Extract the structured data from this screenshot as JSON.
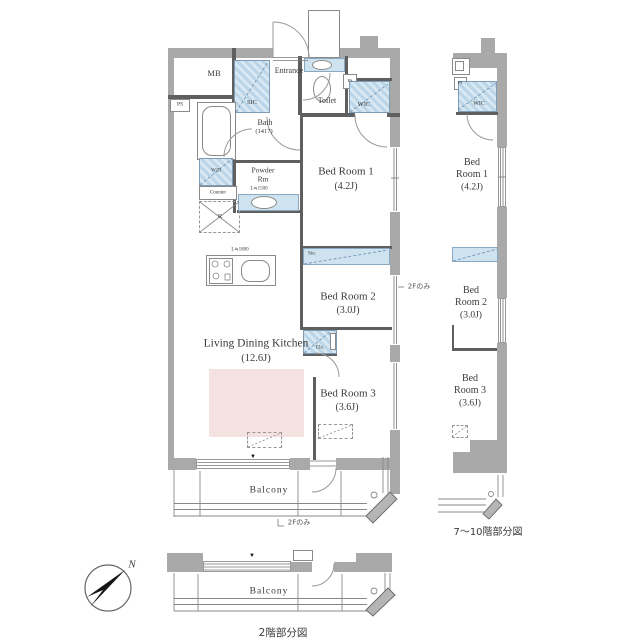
{
  "main_plan": {
    "mb": "MB",
    "ps": "PS",
    "sic": "SIC",
    "entrance": "Entrance",
    "toilet": "Toilet",
    "wic": "WIC",
    "bath": "Bath",
    "bath_size": "(1417)",
    "powder_line1": "Powder",
    "powder_line2": "Rm",
    "powder_counter_len": "L≒1500",
    "washer": "W/D",
    "counter": "Counter",
    "fridge": "R",
    "kitchen_len": "L≒1800",
    "ldk": "Living Dining Kitchen",
    "ldk_size": "(12.6J)",
    "bed1": "Bed Room 1",
    "bed1_size": "(4.2J)",
    "sto": "Sto.",
    "bed2": "Bed Room 2",
    "bed2_size": "(3.0J)",
    "clo": "Clo.",
    "bed3": "Bed Room 3",
    "bed3_size": "(3.6J)",
    "balcony": "Balcony",
    "only_2f_right": "2Fのみ",
    "only_2f_bottom": "2Fのみ"
  },
  "right_plan": {
    "ps": "PS",
    "wic": "WIC",
    "bed1_line1": "Bed",
    "bed1_line2": "Room 1",
    "bed1_size": "(4.2J)",
    "bed2_line1": "Bed",
    "bed2_line2": "Room 2",
    "bed2_size": "(3.0J)",
    "bed3_line1": "Bed",
    "bed3_line2": "Room 3",
    "bed3_size": "(3.6J)",
    "caption": "7〜10階部分図"
  },
  "bottom_plan": {
    "balcony": "Balcony",
    "caption": "2階部分図"
  },
  "compass": {
    "north": "N"
  },
  "markers": {
    "window_center": "▼"
  },
  "colors": {
    "wall": "#a9a9a9",
    "closet_hatch": "#bcd6e8",
    "storage_fill": "#cfe2ef",
    "rug_pink": "#f3e2e0",
    "line": "#8a8a8a"
  }
}
